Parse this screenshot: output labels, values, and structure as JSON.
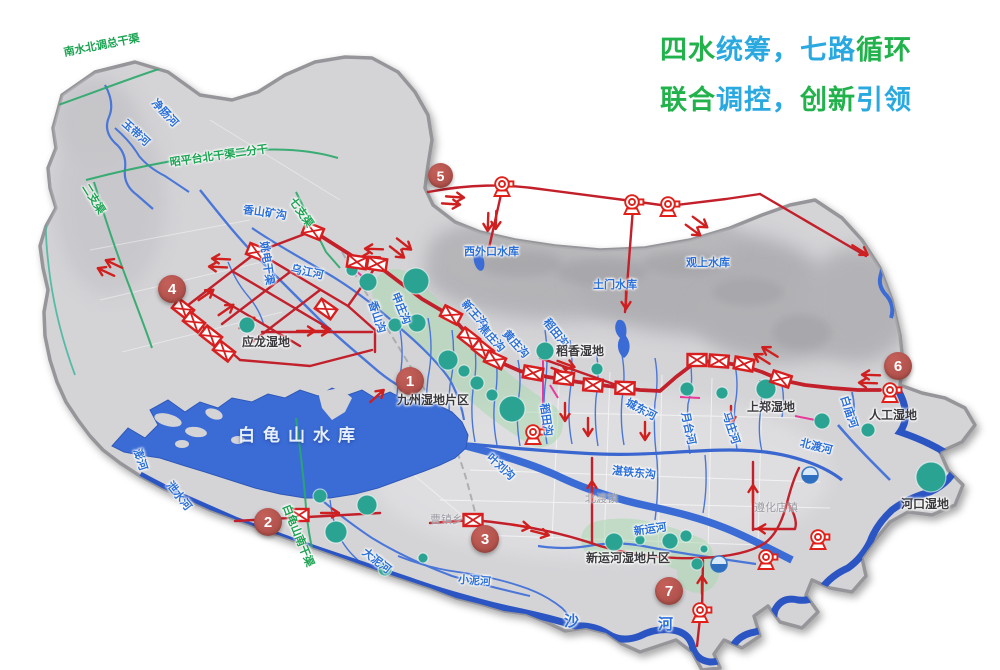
{
  "colors": {
    "green": "#21b24b",
    "cyan": "#2aa9e0",
    "river_blue": "#2b6fd8",
    "canal_green": "#1ba352",
    "label_dark": "#3a3a3e",
    "town_gray": "#9b9ba2",
    "route_red": "#c2202b",
    "marker_red": "#b5534c",
    "wetland_teal": "#2aa392",
    "water": "#4273d6"
  },
  "title": {
    "line1": [
      "四水",
      "统筹，",
      "七路",
      "循环"
    ],
    "line1_colors": [
      "green",
      "cyan",
      "cyan",
      "green"
    ],
    "line2": [
      "联合",
      "调控，",
      "创新",
      "引领"
    ],
    "line2_colors": [
      "green",
      "cyan",
      "green",
      "cyan"
    ]
  },
  "route_markers": {
    "r1": "1",
    "r2": "2",
    "r3": "3",
    "r4": "4",
    "r5": "5",
    "r6": "6",
    "r7": "7"
  },
  "labels": {
    "canals": {
      "nanshuibeidiao": "南水北调总干渠",
      "zhaopingtai": "昭平台北干渠二分干",
      "erzhiqu": "二支渠",
      "qizhiqu": "七支渠",
      "baiguishan_south": "白龟山南干渠"
    },
    "rivers": {
      "jingchang": "净肠河",
      "yudai": "玉带河",
      "xiangshankuang": "香山矿沟",
      "wujiang": "乌江河",
      "yaodian": "姚电干渠",
      "peng": "澎河",
      "xieshui": "泄水河",
      "xiangshan": "香山沟",
      "shenzhuang": "申庄沟",
      "xinwang": "新王沟",
      "jiaozhuang": "焦庄沟",
      "huangzhuang": "黄庄沟",
      "daotian_a": "稻田沟",
      "daotian_b": "稻田沟",
      "chengdong": "城东河",
      "yuetai": "月台河",
      "mazhuang": "马庄河",
      "zhantiedong": "湛铁东沟",
      "yeliu": "叶刘沟",
      "dani": "大泥河",
      "xiaoni": "小泥河",
      "xinyun": "新运河",
      "beidu": "北渡河",
      "baimiao": "白庙河",
      "sha_char1": "沙",
      "sha_char2": "河"
    },
    "reservoirs": {
      "baiguishan": "白龟山水库",
      "xiwaikou": "西外口水库",
      "tumen": "土门水库",
      "guanshang": "观上水库"
    },
    "wetlands": {
      "yinglong": "应龙湿地",
      "jiuzhou": "九州湿地片区",
      "daoxiang": "稻香湿地",
      "shangzheng": "上郑湿地",
      "rengong": "人工湿地",
      "hekou": "河口湿地",
      "xinyunhe": "新运河湿地片区"
    },
    "towns": {
      "beiduzhen": "北渡镇",
      "caozhenxiang": "曹镇乡",
      "zunhuadian": "遵化店镇"
    }
  }
}
